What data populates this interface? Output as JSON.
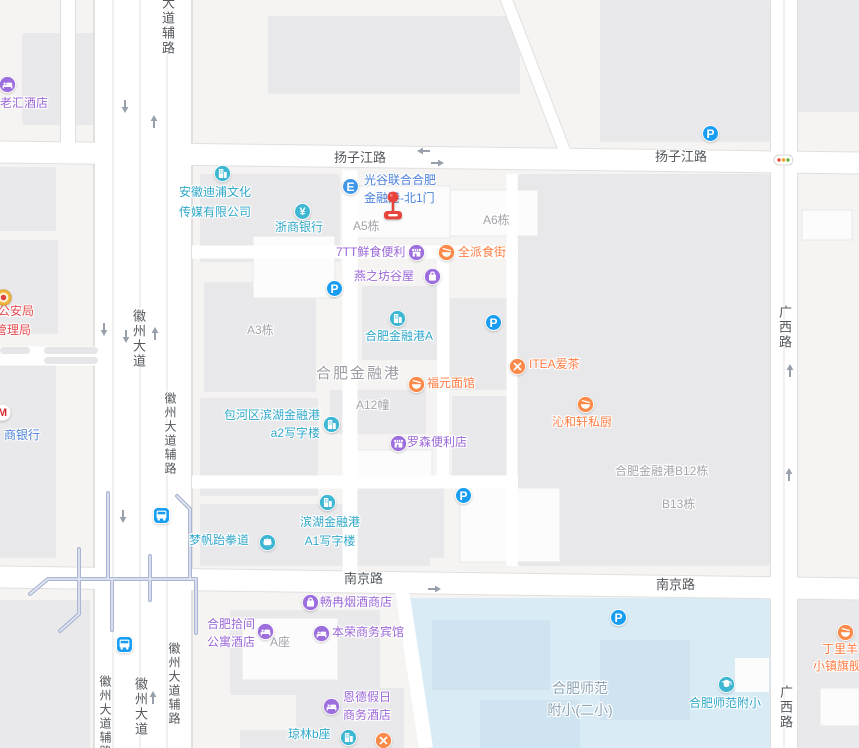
{
  "colors": {
    "teal": "#2fa7c9",
    "purple": "#9a66d6",
    "orange": "#ff7c42",
    "blue": "#4b80d8",
    "red": "#e2484e",
    "gray_label": "#a3a4a9",
    "road_label": "#54585c",
    "parking_blue": "#189df2",
    "water": "#d9ecf6",
    "marker_red": "#e8433d"
  },
  "glyphs": {
    "parking": "P",
    "yen": "¥",
    "entrance": "E",
    "bank_m": "M"
  },
  "roads": {
    "dadao_fu": "大道辅路",
    "yangzijiang": "扬子江路",
    "yangzijiang2": "扬子江路",
    "huizhou": "徽州大道",
    "huizhou_fu": "徽州大道辅路",
    "nanjing": "南京路",
    "nanjing2": "南京路",
    "guangxi": "广西路",
    "guangxi2": "广西路",
    "huizhou_fu_bl": "徽州大道辅路",
    "huizhou_b": "徽州大道",
    "huizhou_fu_br": "徽州大道辅路"
  },
  "pois": {
    "laohui": "老汇酒店",
    "gongan1": "市公安局",
    "gongan2": "管理局",
    "shangbank": "商银行",
    "anhui1": "安徽迪浦文化",
    "anhui2": "传媒有限公司",
    "zheshang": "浙商银行",
    "guanggu1": "光谷联合合肥",
    "guanggu2": "金融港-北1门",
    "qtt": "7TT鲜食便利",
    "quanpai": "全派食街",
    "yanzhifang": "燕之坊谷屋",
    "jrga": "合肥金融港A",
    "itea": "ITEA爱茶",
    "fuyuan": "福元面馆",
    "qinhexuan": "沁和轩私厨",
    "baohe1": "包河区滨湖金融港",
    "baohe2": "a2写字楼",
    "luosen": "罗森便利店",
    "binhu1": "滨湖金融港",
    "binhu2": "A1写字楼",
    "mengfan": "梦帆跆拳道",
    "changran": "畅冉烟酒商店",
    "hfsj1": "合肥拾间",
    "hfsj2": "公寓酒店",
    "benrong": "本荣商务宾馆",
    "ende1": "恩德假日",
    "ende2": "商务酒店",
    "qionglin": "琼林b座",
    "shifanpoi": "合肥师范附小",
    "dly1": "丁里羊",
    "dly2": "小镇旗舰店"
  },
  "buildings": {
    "a5": "A5栋",
    "a6": "A6栋",
    "a3": "A3栋",
    "a12": "A12幢",
    "azuo": "A座",
    "jrg": "合肥金融港",
    "b12": "合肥金融港B12栋",
    "b13": "B13栋",
    "shifan1": "合肥师范",
    "shifan2": "附小(二小)"
  }
}
